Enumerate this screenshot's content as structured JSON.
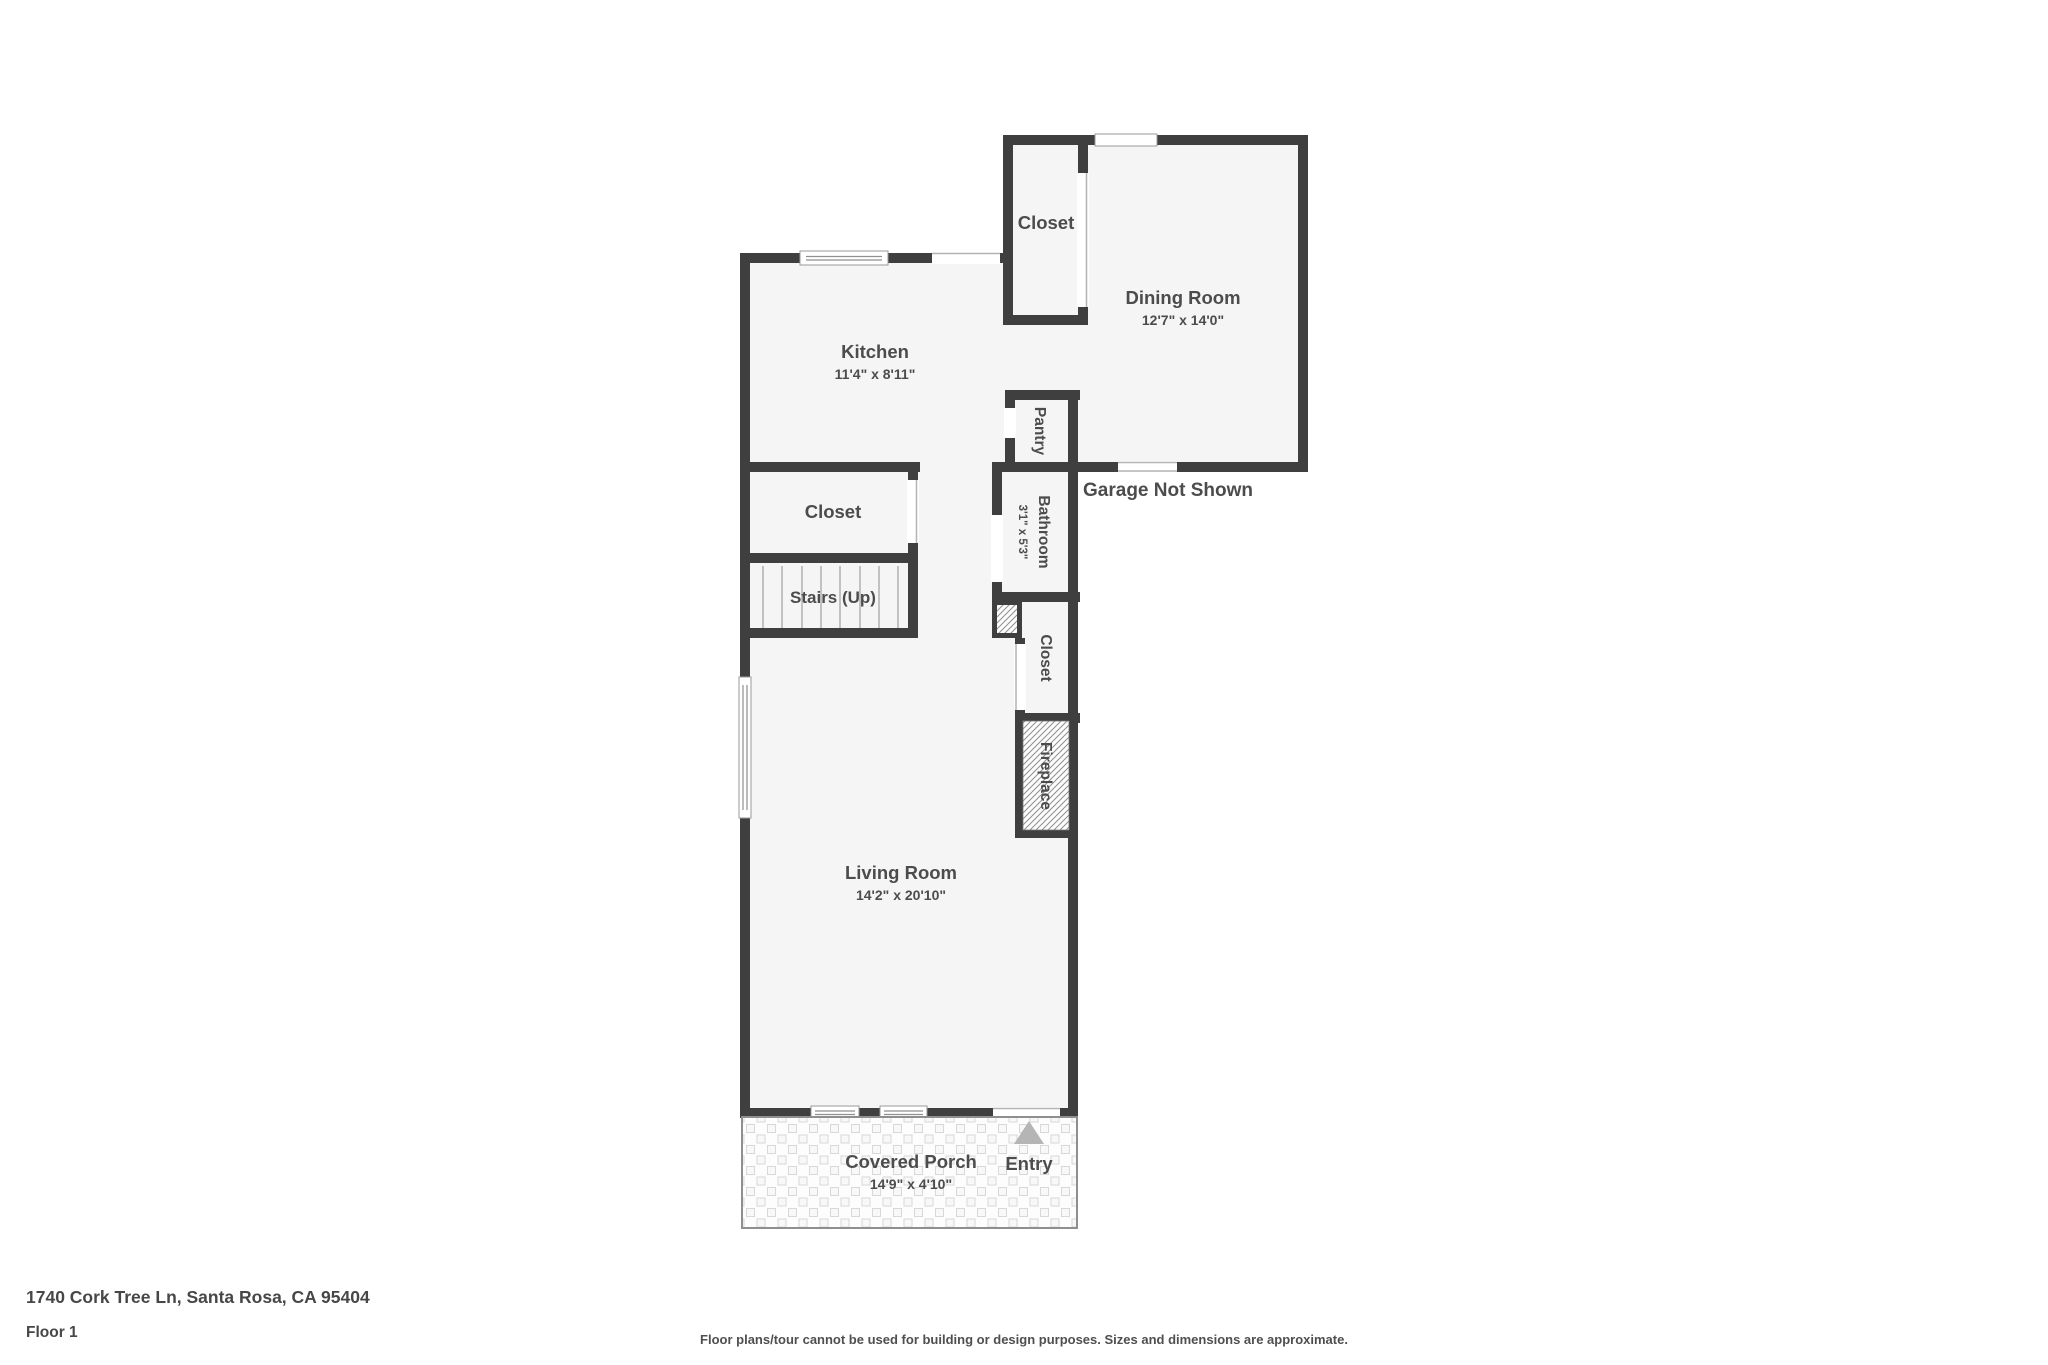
{
  "floorplan": {
    "rooms": {
      "dining": {
        "label": "Dining Room",
        "dims": "12'7\" x 14'0\""
      },
      "kitchen": {
        "label": "Kitchen",
        "dims": "11'4\" x 8'11\""
      },
      "living": {
        "label": "Living Room",
        "dims": "14'2\" x 20'10\""
      },
      "porch": {
        "label": "Covered Porch",
        "dims": "14'9\" x 4'10\""
      },
      "bathroom": {
        "label": "Bathroom",
        "dims": "3'1\" x 5'3\""
      },
      "pantry": {
        "label": "Pantry"
      },
      "closet_top": {
        "label": "Closet"
      },
      "closet_left": {
        "label": "Closet"
      },
      "closet_right": {
        "label": "Closet"
      },
      "fireplace": {
        "label": "Fireplace"
      },
      "stairs": {
        "label": "Stairs (Up)"
      },
      "entry": {
        "label": "Entry"
      }
    },
    "notes": {
      "garage": "Garage Not Shown"
    },
    "colors": {
      "wall": "#3f3f3f",
      "room_fill": "#f5f5f5",
      "label_text": "#4c4c4c",
      "entry_arrow": "#b5b5b5",
      "hatch_line": "#8f8f8f",
      "tile_line": "#d8d8d8"
    }
  },
  "footer": {
    "address": "1740 Cork Tree Ln, Santa Rosa, CA 95404",
    "floor": "Floor 1",
    "disclaimer": "Floor plans/tour cannot be used for building or design purposes. Sizes and dimensions are approximate."
  }
}
